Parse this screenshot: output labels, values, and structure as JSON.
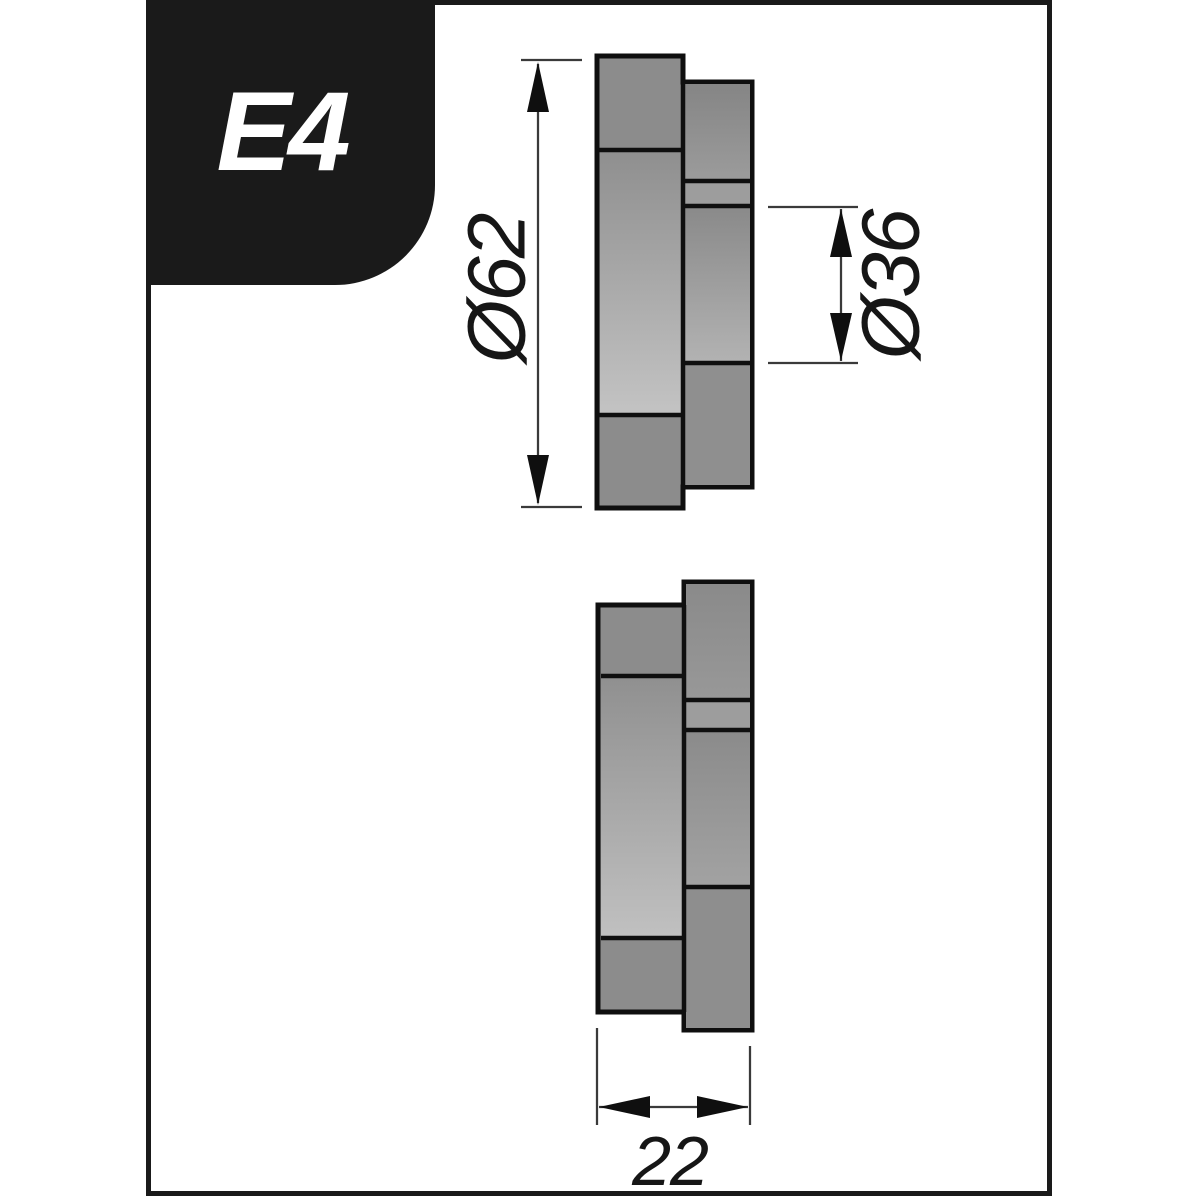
{
  "page": {
    "background": "#ffffff"
  },
  "frame": {
    "stroke_color": "#1a1a1a"
  },
  "badge": {
    "label": "E4",
    "background": "#1a1a1a",
    "text_color": "#ffffff"
  },
  "rollers": {
    "fill": "#8c8c8c",
    "outline_color": "#0f0f0f",
    "views": [
      "upper-roller-cross-section",
      "lower-roller-cross-section"
    ]
  },
  "dimensions": {
    "line_color": "#3a3a3a",
    "outer_diameter": {
      "label": "Ø62"
    },
    "inner_diameter": {
      "label": "Ø36"
    },
    "width": {
      "label": "22"
    }
  }
}
